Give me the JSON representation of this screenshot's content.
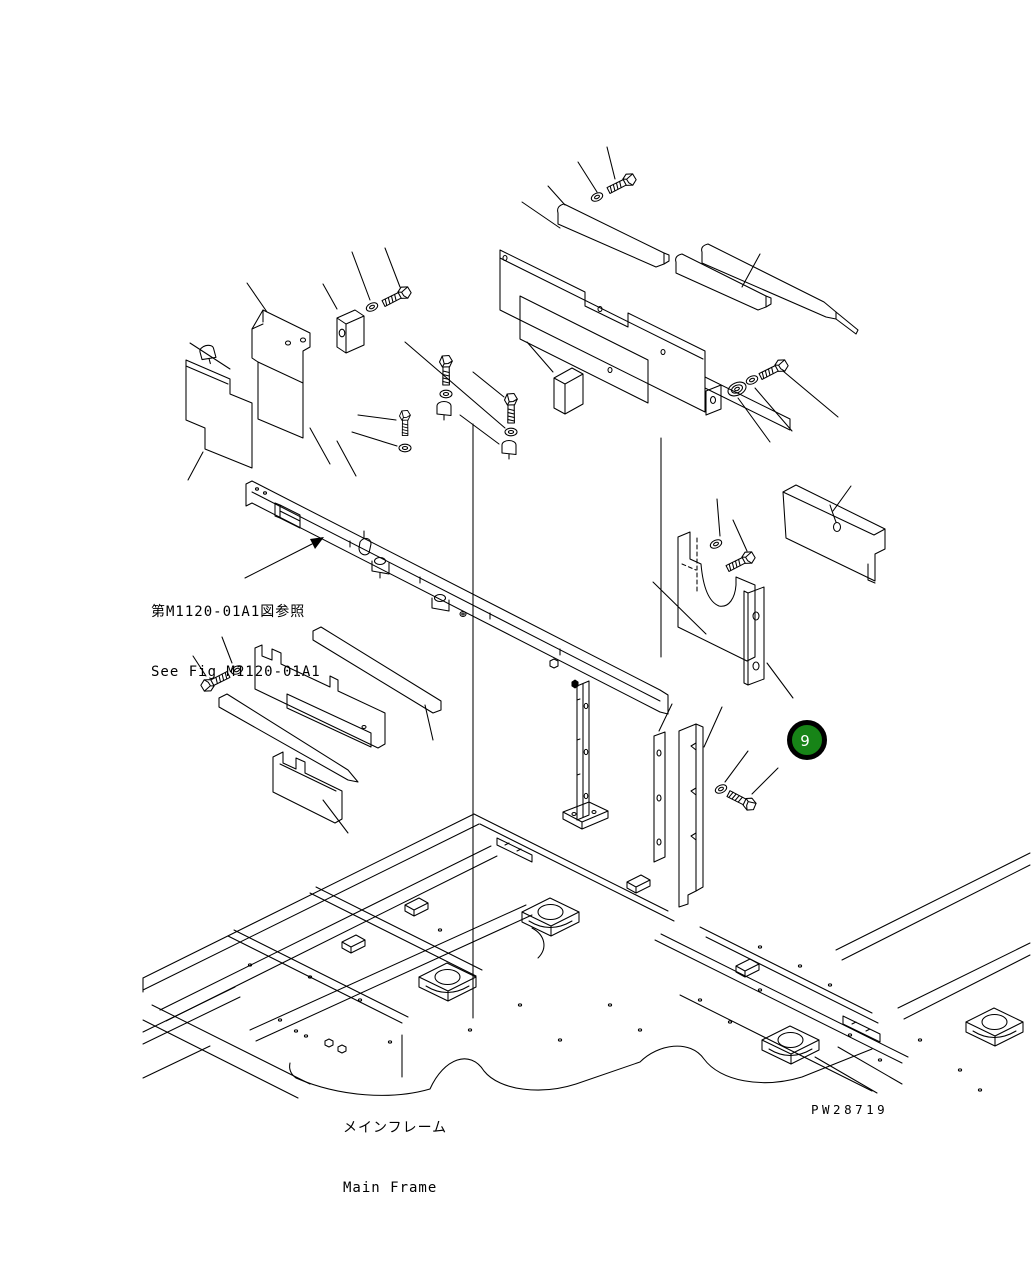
{
  "page": {
    "background_color": "#ffffff",
    "line_color": "#000000",
    "type": "exploded-parts-diagram"
  },
  "annotations": {
    "see_fig": {
      "jp": "第M1120-01A1図参照",
      "en": "See Fig M1120-01A1"
    },
    "main_frame": {
      "jp": "メインフレーム",
      "en": "Main Frame"
    },
    "drawing_number": "PW28719",
    "callout": {
      "number": "9",
      "fill": "#178417",
      "ring": "#000000",
      "text_color": "#ffffff"
    }
  }
}
